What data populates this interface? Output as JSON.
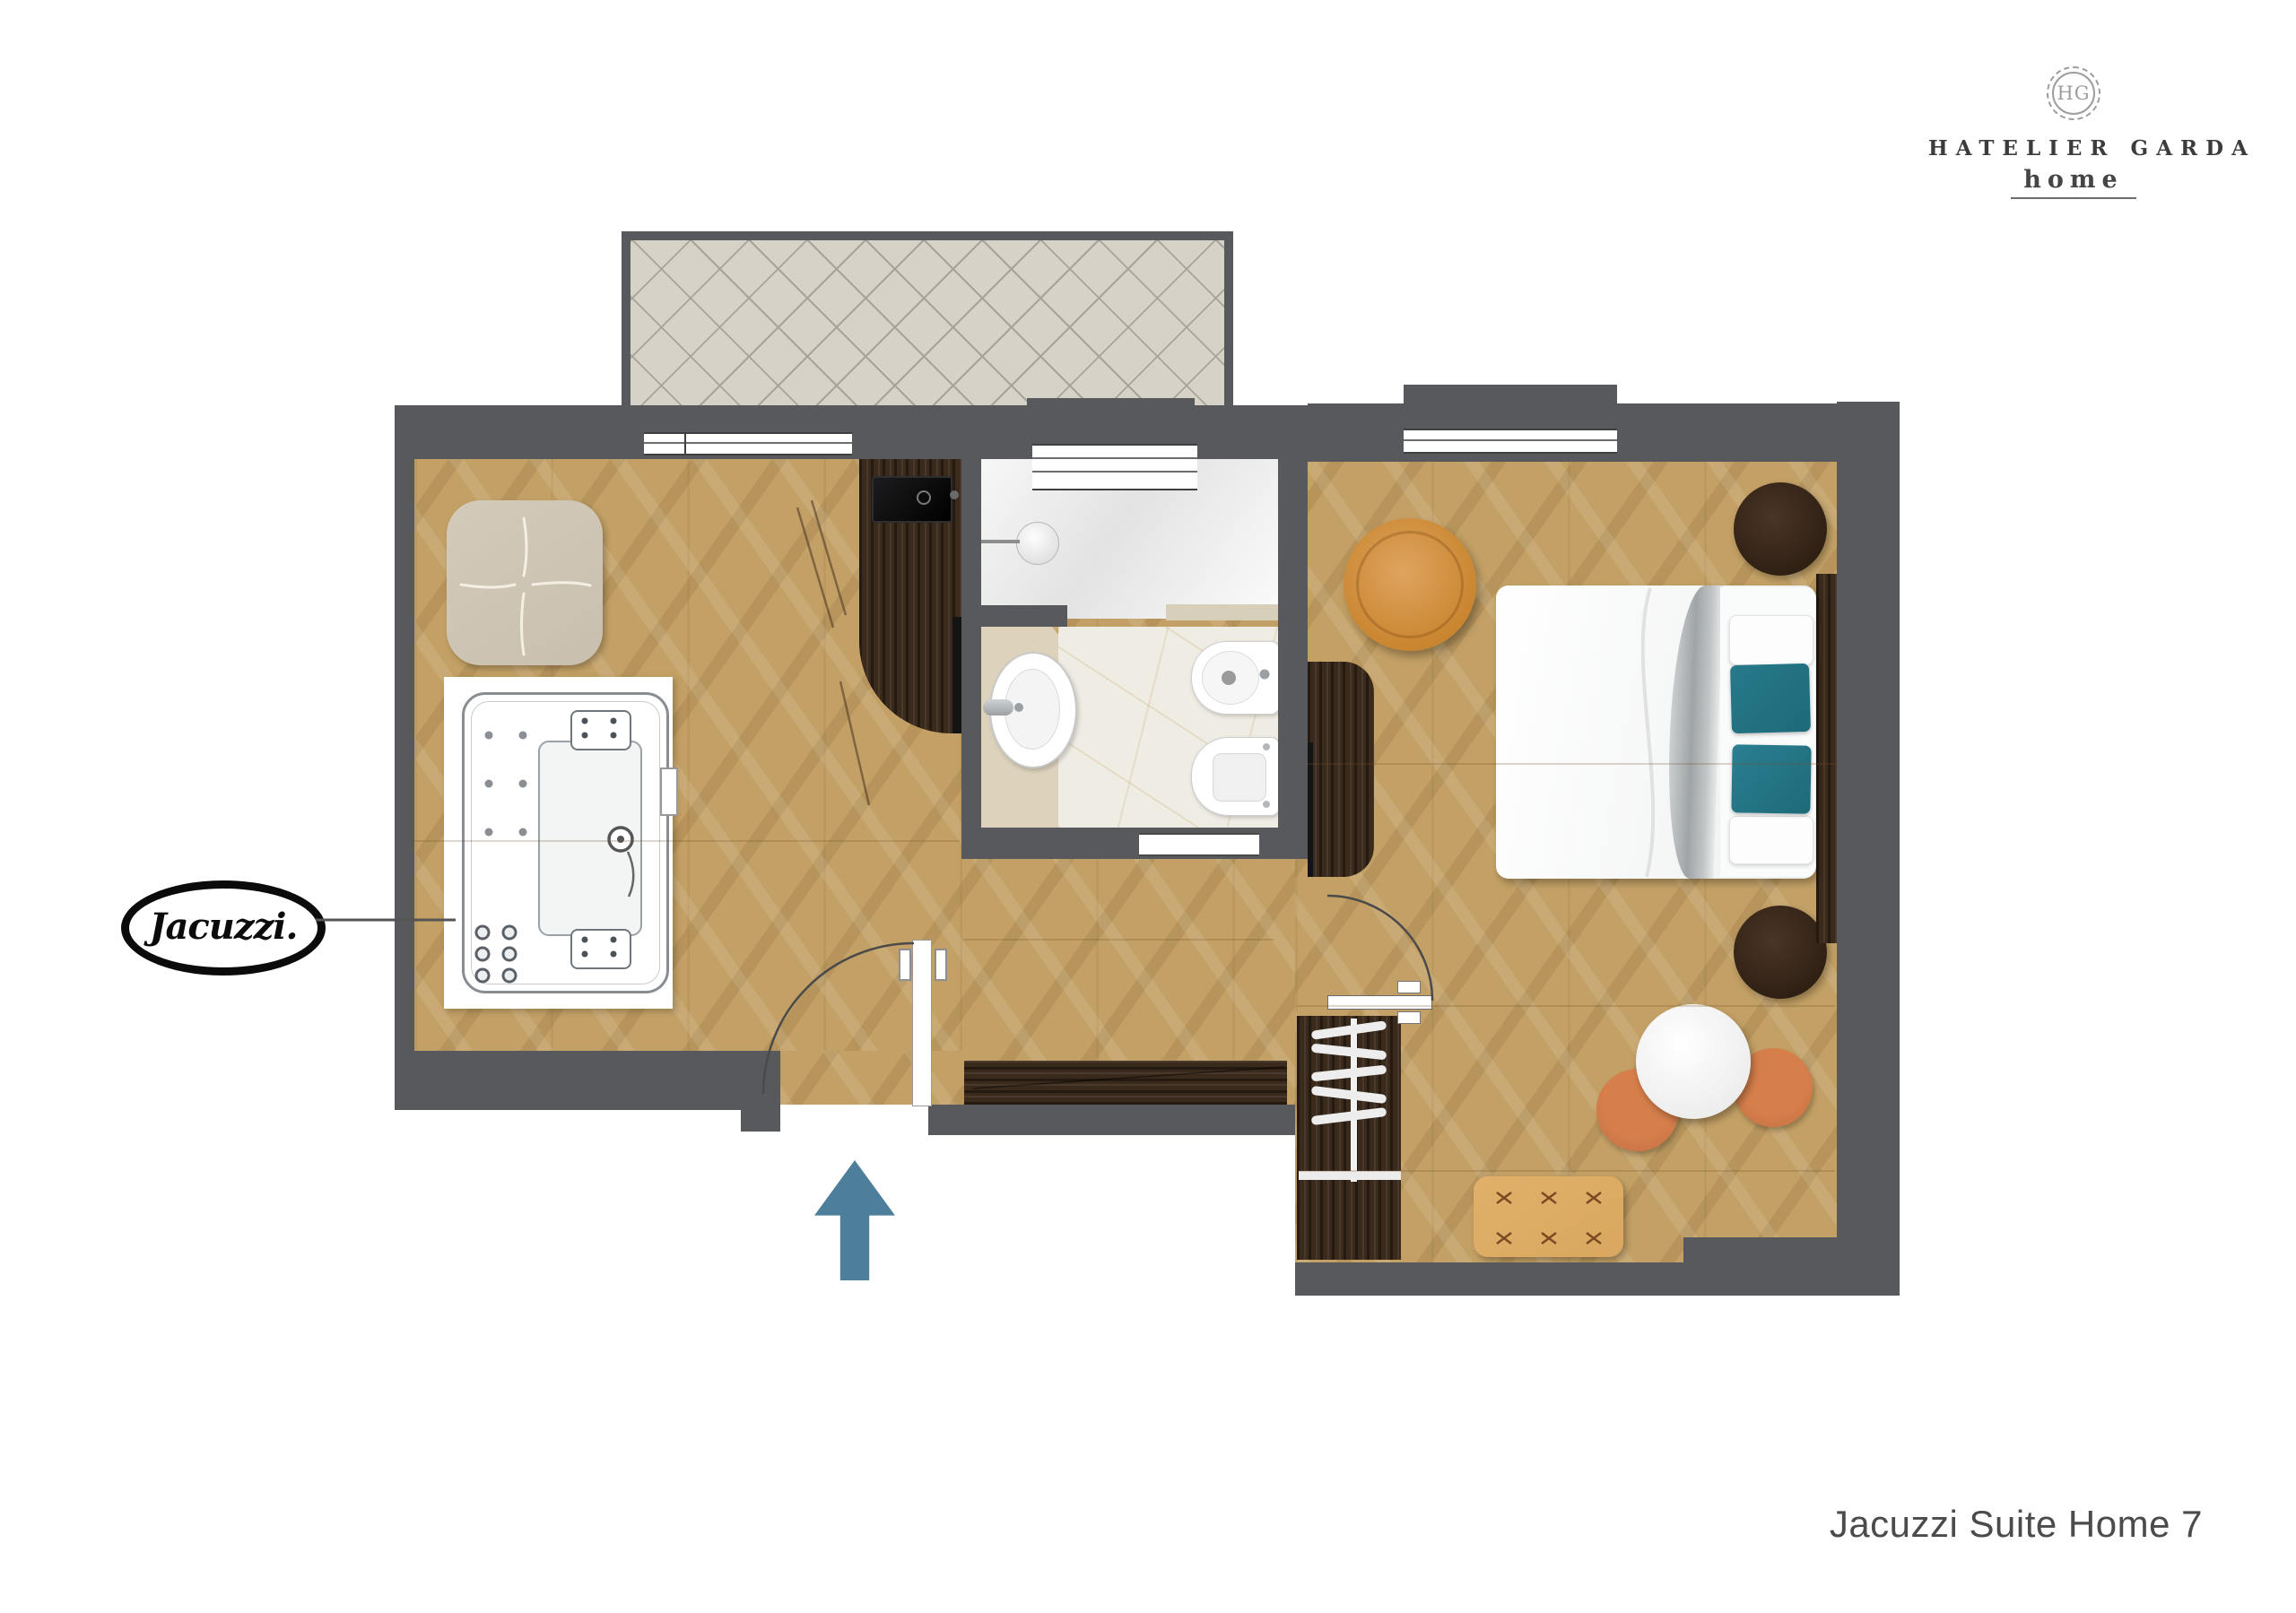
{
  "brand": {
    "monogram": "HG",
    "name": "HATELIER GARDA",
    "subtitle": "home"
  },
  "footer": {
    "title": "Jacuzzi Suite Home 7"
  },
  "plan": {
    "type": "apartment floor plan, top view",
    "brand_label": {
      "text": "Jacuzzi."
    },
    "entrance": {
      "symbol": "arrow-up",
      "meaning": "entrance direction"
    },
    "rooms": [
      "terrace",
      "living-jacuzzi-room",
      "bathroom",
      "bedroom",
      "entry-hall"
    ]
  },
  "theme": {
    "colors": {
      "wall": "#58595c",
      "wood": "#c3a065",
      "darkwood": "#3a2a1c",
      "tile": "#d6d2c8",
      "marble": "#efece3",
      "counter": "#ddd3bd",
      "teal": "#1d6a79",
      "terracotta": "#cd7647",
      "tan": "#d9a75f",
      "orange": "#cf8b3e",
      "arrowblue": "#4d7e9a"
    }
  }
}
